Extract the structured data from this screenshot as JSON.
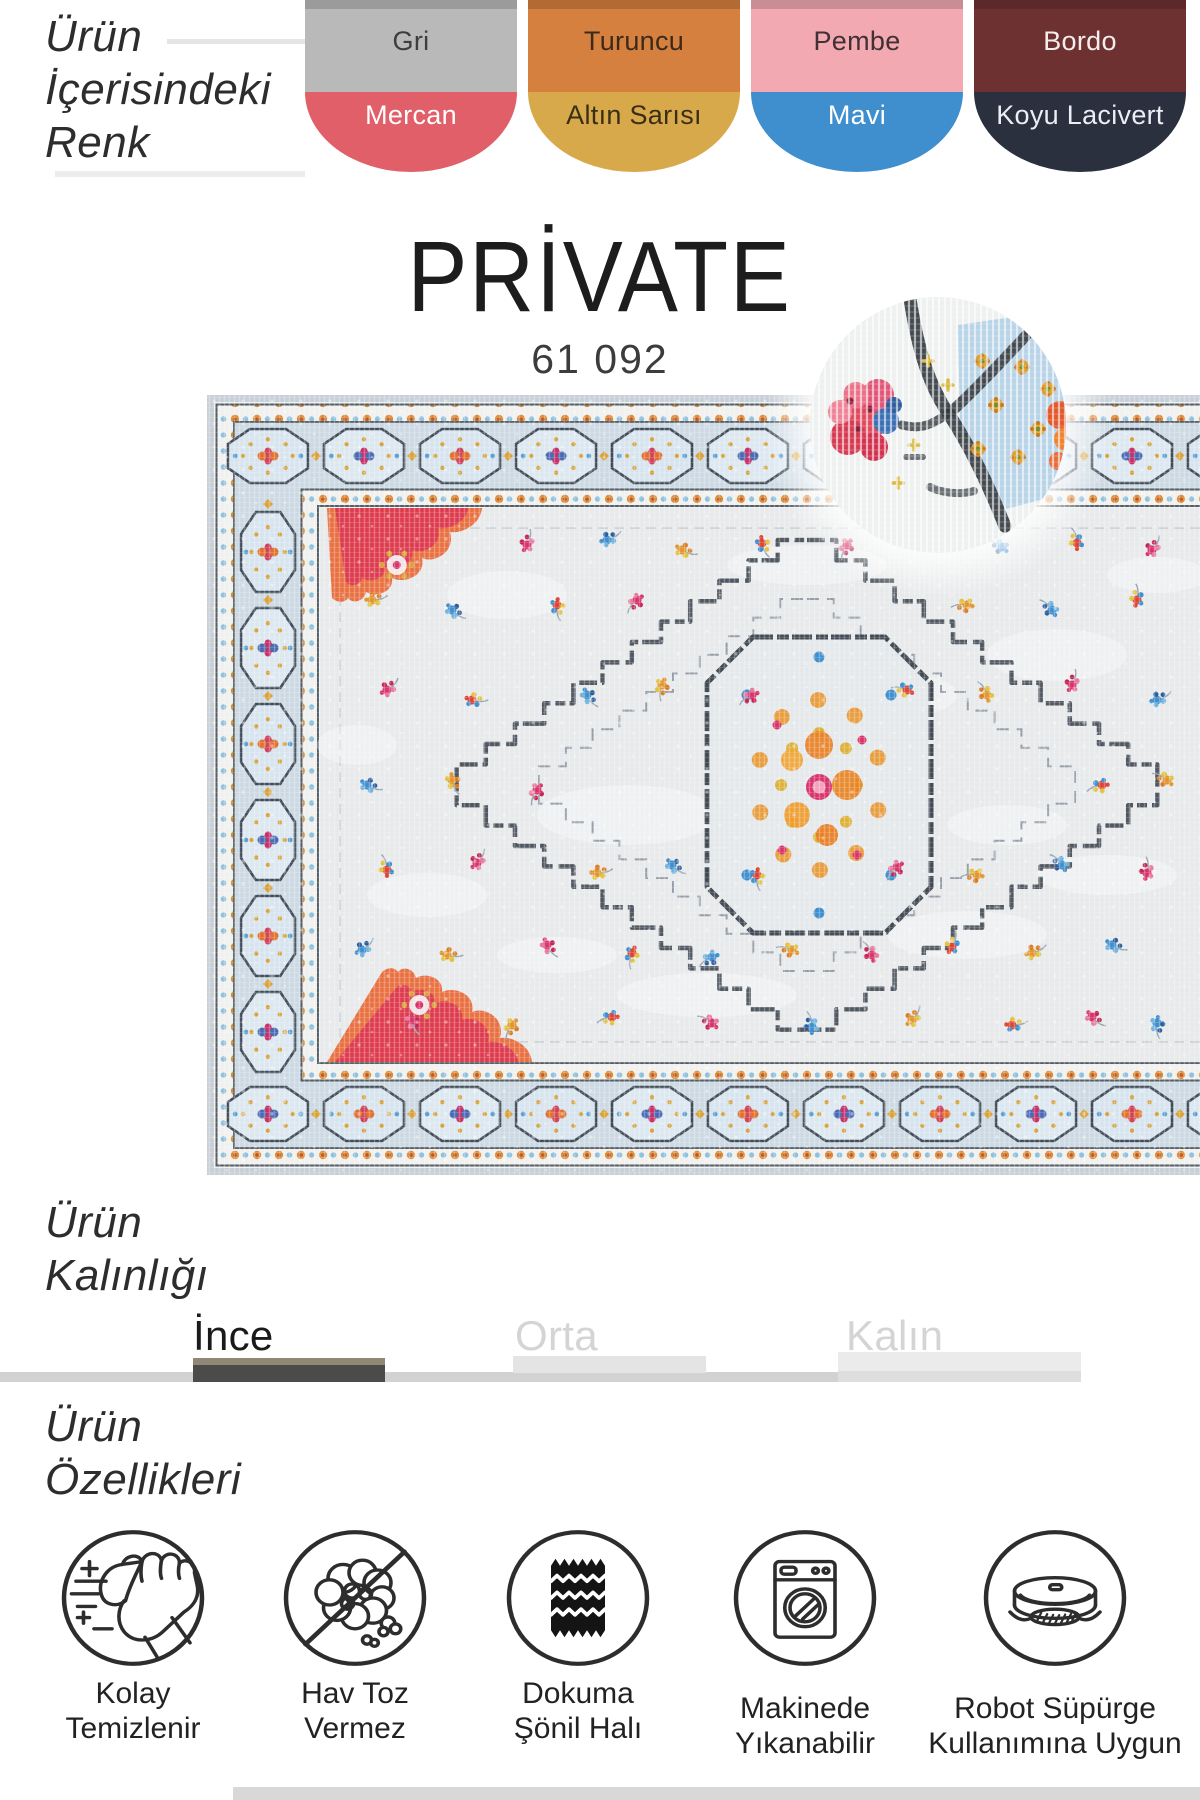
{
  "palette_section": {
    "heading_lines": [
      "Ürün",
      "İçerisindeki",
      "Renk"
    ],
    "swatches": [
      {
        "top": {
          "label": "Gri",
          "color": "#b9b9b9",
          "text": "#3d3d3d"
        },
        "bottom": {
          "label": "Mercan",
          "color": "#e05f68",
          "text": "#ffffff"
        }
      },
      {
        "top": {
          "label": "Turuncu",
          "color": "#d5803e",
          "text": "#3b2a1a"
        },
        "bottom": {
          "label": "Altın Sarısı",
          "color": "#d8a94b",
          "text": "#3a2f15"
        }
      },
      {
        "top": {
          "label": "Pembe",
          "color": "#f2a9b2",
          "text": "#413034"
        },
        "bottom": {
          "label": "Mavi",
          "color": "#3f8ecd",
          "text": "#ffffff"
        }
      },
      {
        "top": {
          "label": "Bordo",
          "color": "#6d3132",
          "text": "#f7ecec"
        },
        "bottom": {
          "label": "Koyu Lacivert",
          "color": "#2b303f",
          "text": "#eceef5"
        }
      }
    ]
  },
  "product": {
    "name": "PRİVATE",
    "code": "61 092"
  },
  "thickness": {
    "heading_lines": [
      "Ürün",
      "Kalınlığı"
    ],
    "options": [
      {
        "label": "İnce",
        "selected": true
      },
      {
        "label": "Orta",
        "selected": false
      },
      {
        "label": "Kalın",
        "selected": false
      }
    ]
  },
  "features": {
    "heading_lines": [
      "Ürün",
      "Özellikleri"
    ],
    "items": [
      {
        "icon": "easy-clean",
        "label_lines": [
          "Kolay",
          "Temizlenir"
        ]
      },
      {
        "icon": "no-lint",
        "label_lines": [
          "Hav Toz",
          "Vermez"
        ]
      },
      {
        "icon": "woven-chenille",
        "label_lines": [
          "Dokuma",
          "Şönil Halı"
        ]
      },
      {
        "icon": "machine-washable",
        "label_lines": [
          "Makinede",
          "Yıkanabilir"
        ]
      },
      {
        "icon": "robot-vacuum",
        "label_lines": [
          "Robot Süpürge",
          "Kullanımına Uygun"
        ]
      }
    ]
  },
  "visual": {
    "accent_dark": "#2f2f2f",
    "bar_track": "#d2d2d2",
    "bar_selected": "#4b4b49",
    "bar_selected_top": "#8e8875",
    "bar_unselected": "#e4e4e4",
    "muted_label": "#d4d4d4",
    "bottom_bar": "#d8d8d8",
    "rug": {
      "edge": "#c7ced5",
      "ground": "#e7e9ea",
      "border_ground": "#ccd9e3",
      "octagon_fill": "#d7e4ee",
      "outline": "#3a424c",
      "gold": "#d9a23a",
      "orange": "#e8821f",
      "red": "#dd3b4e",
      "magenta": "#d8336b",
      "blue": "#3f8ecd",
      "light_blue": "#b7d3e7",
      "navy": "#31373d",
      "cream": "#f0f1ee"
    }
  }
}
